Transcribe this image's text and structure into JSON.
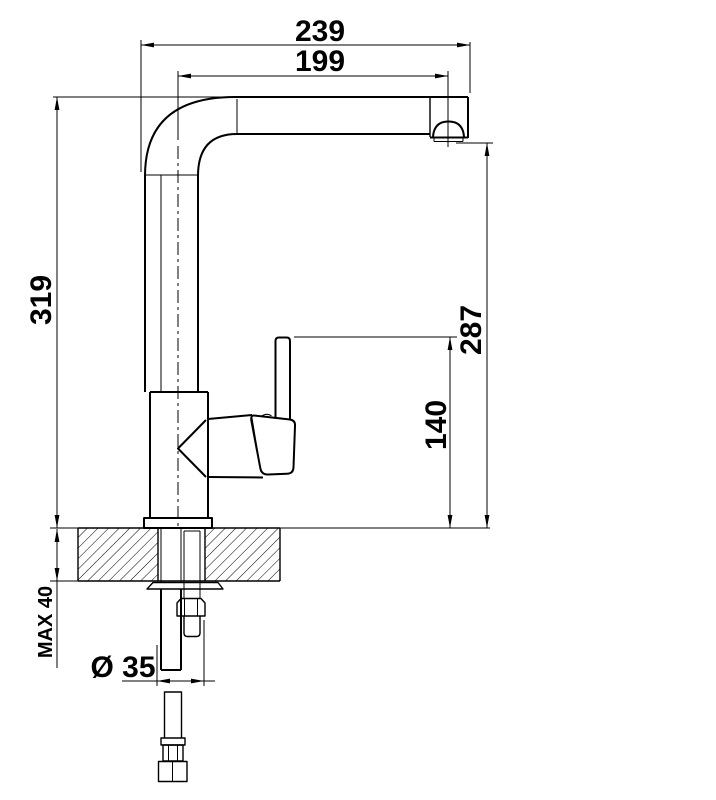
{
  "drawing": {
    "kind": "single-lever kitchen faucet installation dimension drawing",
    "colors": {
      "line": "#000000",
      "background": "#ffffff"
    },
    "dims": {
      "overall_reach": "239",
      "spout_reach": "199",
      "overall_height": "319",
      "outlet_height": "287",
      "handle_height": "140",
      "max_counter_thickness": "MAX 40",
      "hole_diameter": "Ø 35"
    }
  }
}
